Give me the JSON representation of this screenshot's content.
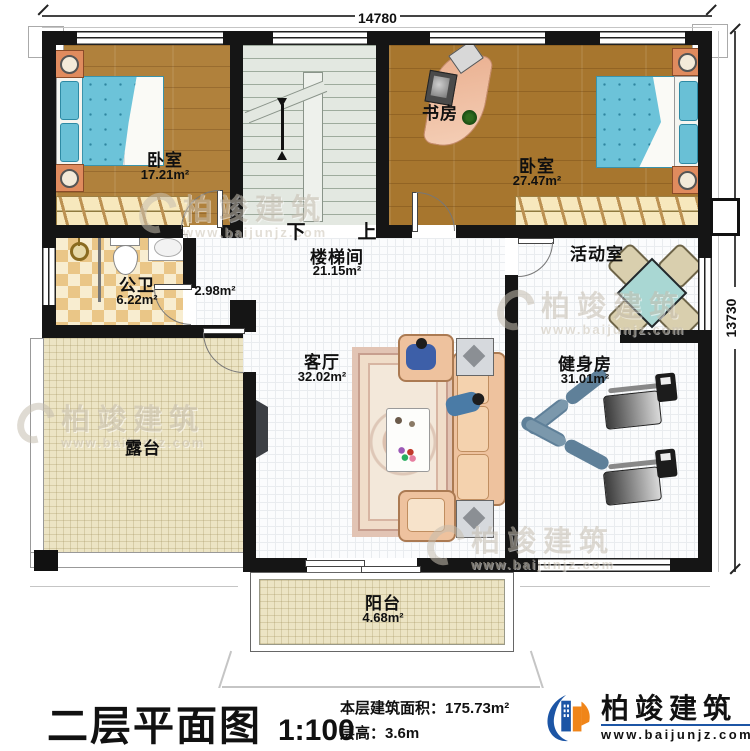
{
  "plan": {
    "dimensions": {
      "width_label": "14780",
      "height_label": "13730"
    },
    "rooms": {
      "bedroom_left": {
        "name": "卧室",
        "area": "17.21m²"
      },
      "study": {
        "name": "书房"
      },
      "bedroom_right": {
        "name": "卧室",
        "area": "27.47m²"
      },
      "stairwell": {
        "name": "楼梯间",
        "area": "21.15m²",
        "down": "下",
        "up": "上"
      },
      "bathroom": {
        "name": "公卫",
        "area": "6.22m²"
      },
      "closet": {
        "area": "2.98m²"
      },
      "activity": {
        "name": "活动室"
      },
      "living": {
        "name": "客厅",
        "area": "32.02m²"
      },
      "gym": {
        "name": "健身房",
        "area": "31.01m²"
      },
      "terrace": {
        "name": "露台"
      },
      "balcony": {
        "name": "阳台",
        "area": "4.68m²"
      }
    }
  },
  "watermark": {
    "brand": "柏竣建筑",
    "url": "www.baijunjz.com"
  },
  "footer": {
    "title": "二层平面图",
    "scale": "1:100",
    "area_line": "本层建筑面积：175.73m²",
    "height_line": "层高：3.6m",
    "brand": "柏竣建筑",
    "brand_url": "www.baijunjz.com"
  },
  "colors": {
    "wall": "#151515",
    "wood_floor": "#b0813c",
    "bed_fabric": "#6cc3d9",
    "brand_blue": "#1c55a5",
    "brand_orange": "#f08519",
    "activity_table": "#a9d7d3"
  }
}
